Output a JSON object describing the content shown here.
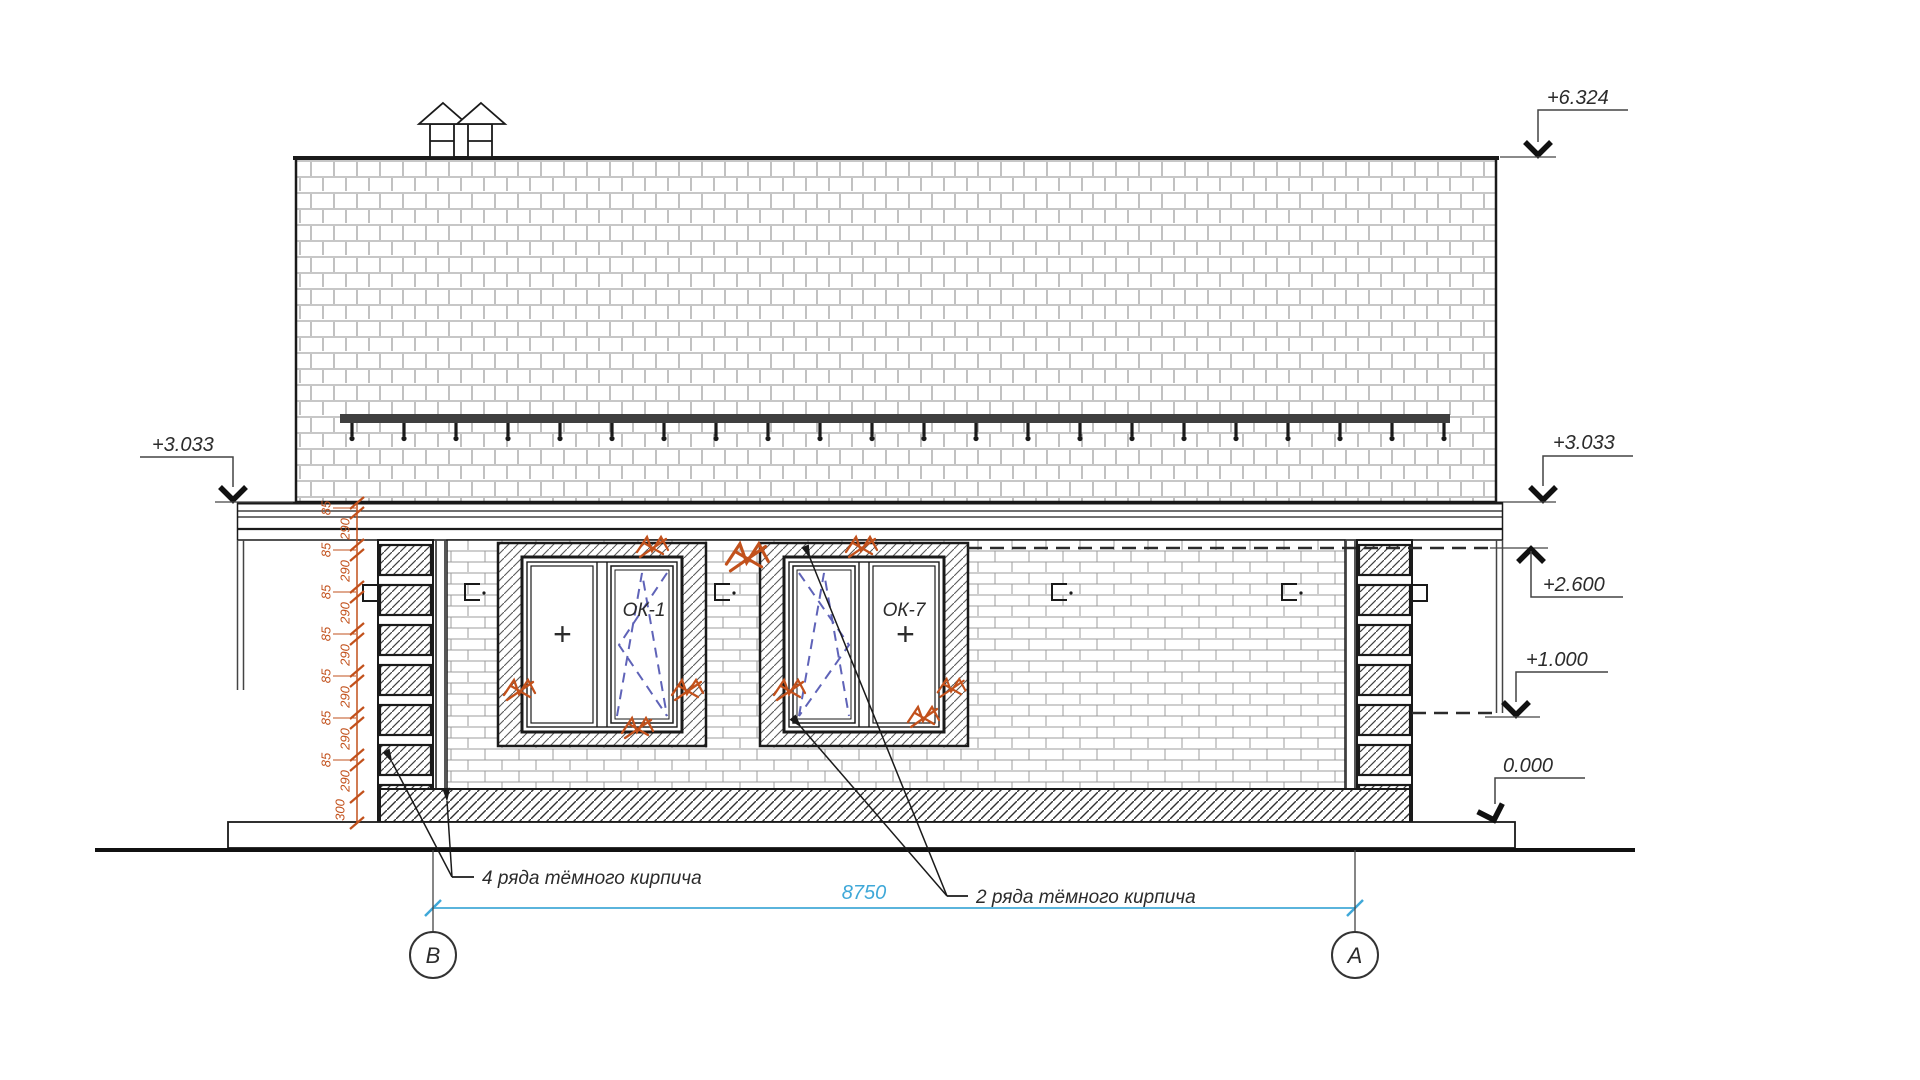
{
  "drawing": {
    "elevation_marks": {
      "ridge": "+6.324",
      "eave_left": "+3.033",
      "eave_right": "+3.033",
      "lintel": "+2.600",
      "mid": "+1.000",
      "floor": "0.000"
    },
    "windows": {
      "w1": "ОК-1",
      "w2": "ОК-7",
      "fixed_symbol": "+"
    },
    "annotations": {
      "dark_brick_4": "4 ряда тёмного кирпича",
      "dark_brick_2": "2 ряда тёмного кирпича"
    },
    "dimensions": {
      "overall_width": "8750",
      "left_chain": [
        "85",
        "290",
        "85",
        "290",
        "85",
        "290",
        "85",
        "290",
        "85",
        "290",
        "85",
        "290",
        "85",
        "290",
        "300"
      ]
    },
    "axes": {
      "left": "В",
      "right": "А"
    },
    "colors": {
      "dimension_accent": "#3fa8d8",
      "chain_accent": "#c2511c",
      "sash_dash": "#5f63b8",
      "line": "#1a1a1a"
    }
  }
}
